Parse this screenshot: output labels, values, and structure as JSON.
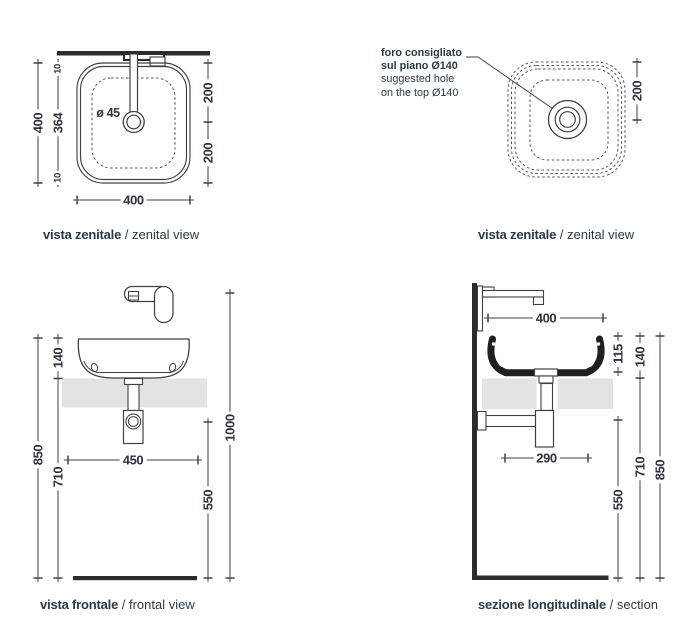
{
  "palette": {
    "line": "#414141",
    "thick_wall": "#2c2c2c",
    "counter_fill": "#e3e3e3",
    "section_fill": "#1f1f1f",
    "text": "#2b3a47"
  },
  "views": {
    "zenital_left": {
      "caption_bold": "vista zenitale",
      "caption_rest": "/ zenital view",
      "dims": {
        "left_outer": "400",
        "inner_top": "10",
        "inner_mid": "364",
        "inner_bottom": "10",
        "right_top": "200",
        "right_bottom": "200",
        "bottom": "400",
        "drain": "ø 45"
      }
    },
    "zenital_right": {
      "caption_bold": "vista zenitale",
      "caption_rest": "/ zenital view",
      "note": {
        "line1": "foro consigliato",
        "line2": "sul piano Ø140",
        "line3": "suggested hole",
        "line4": "on the top Ø140"
      },
      "dims": {
        "right": "200"
      }
    },
    "frontal": {
      "caption_bold": "vista frontale",
      "caption_rest": "/ frontal view",
      "dims": {
        "basin_height": "140",
        "wall_height": "850",
        "under_height": "710",
        "shelf_width": "450",
        "total_height": "1000",
        "trap_height": "550"
      }
    },
    "section": {
      "caption_bold": "sezione longitudinale",
      "caption_rest": "/ section",
      "dims": {
        "depth": "400",
        "inner_depth": "115",
        "basin_height": "140",
        "trap_depth": "290",
        "trap_height": "550",
        "under_height": "710",
        "wall_height": "850"
      }
    }
  }
}
